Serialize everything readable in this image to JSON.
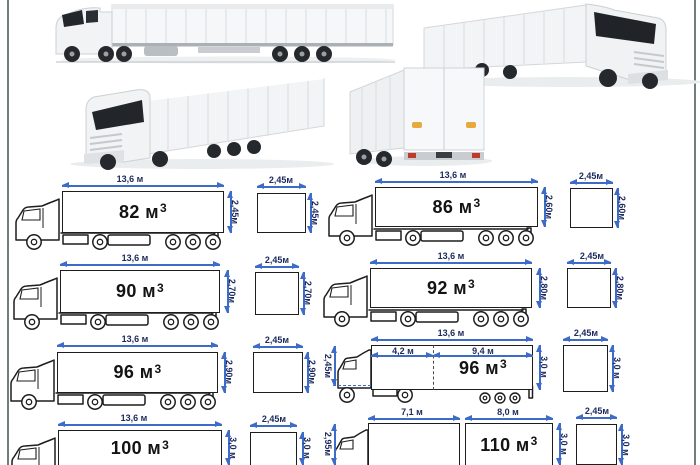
{
  "colors": {
    "dimension_blue": "#3c6cc8",
    "dimension_text_navy": "#1c2a5e",
    "schematic_line": "#1d1d1d",
    "frame_line": "#6f7f7e",
    "marker_orange": "#e7a93d"
  },
  "photos": {
    "photo1": "truck-side-view",
    "photo2": "truck-front-three-quarter-left",
    "photo3": "truck-front-three-quarter-right",
    "photo4": "truck-rear-three-quarter"
  },
  "panels": [
    {
      "volume": "82 м",
      "exp": "3",
      "length": "13,6 м",
      "height": "2,45м",
      "section_width": "2,45м",
      "section_height": "2,45м"
    },
    {
      "volume": "86 м",
      "exp": "3",
      "length": "13,6 м",
      "height": "2,60м",
      "section_width": "2,45м",
      "section_height": "2,60м"
    },
    {
      "volume": "90 м",
      "exp": "3",
      "length": "13,6 м",
      "height": "2,70м",
      "section_width": "2,45м",
      "section_height": "2,70м"
    },
    {
      "volume": "92 м",
      "exp": "3",
      "length": "13,6 м",
      "height": "2,80м",
      "section_width": "2,45м",
      "section_height": "2,80м"
    },
    {
      "volume": "96 м",
      "exp": "3",
      "length": "13,6 м",
      "height": "2,90м",
      "section_width": "2,45м",
      "section_height": "2,90м"
    },
    {
      "volume": "96 м",
      "exp": "3",
      "length": "13,6 м",
      "height": "3,0 м",
      "front_height": "2,45м",
      "segment1": "4,2 м",
      "segment2": "9,4 м",
      "section_width": "2,45м",
      "section_height": "3,0 м"
    },
    {
      "volume": "100 м",
      "exp": "3",
      "length": "13,6 м",
      "height": "3,0 м",
      "section_width": "2,45м",
      "section_height": "3,0 м"
    },
    {
      "volume": "110 м",
      "exp": "3",
      "segment1": "7,1 м",
      "segment2": "8,0 м",
      "height": "3,0 м",
      "front_height": "2,95м",
      "section_width": "2,45м",
      "section_height": "3,0 м"
    }
  ]
}
